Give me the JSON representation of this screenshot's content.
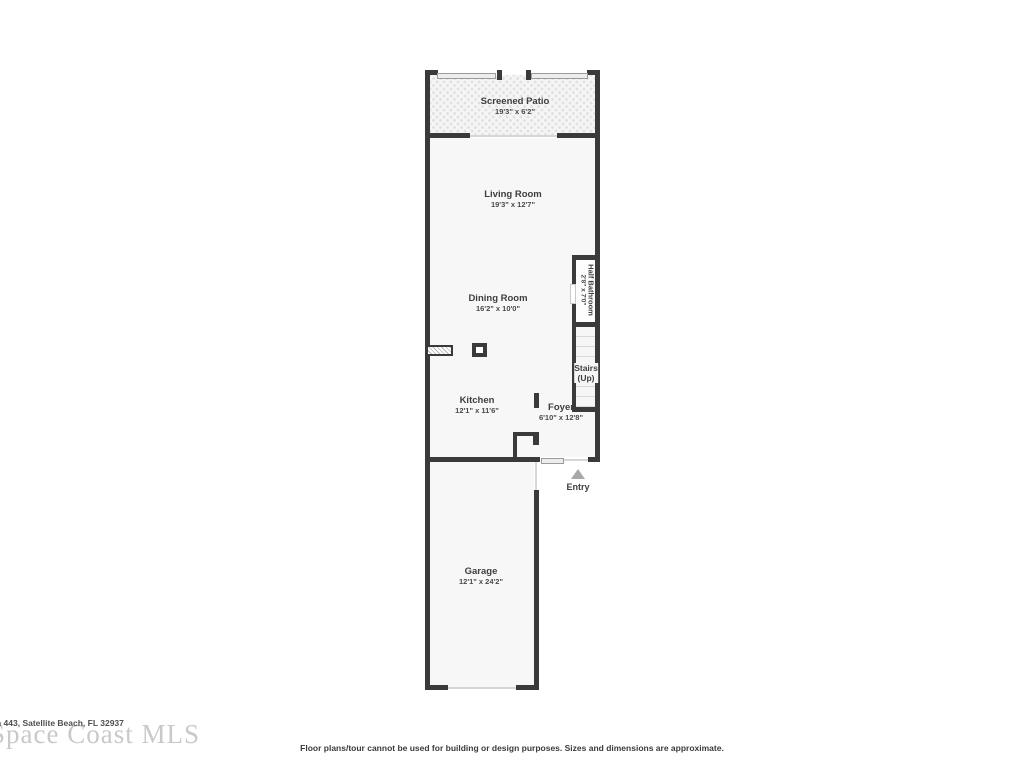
{
  "floor_plan": {
    "rooms": {
      "screened_patio": {
        "name": "Screened Patio",
        "dims": "19'3\" x 6'2\""
      },
      "living_room": {
        "name": "Living Room",
        "dims": "19'3\" x 12'7\""
      },
      "dining_room": {
        "name": "Dining Room",
        "dims": "16'2\" x 10'0\""
      },
      "half_bathroom": {
        "name": "Half Bathroom",
        "dims": "2'8\" x 7'0\""
      },
      "stairs": {
        "name": "Stairs",
        "direction": "(Up)"
      },
      "kitchen": {
        "name": "Kitchen",
        "dims": "12'1\" x 11'6\""
      },
      "foyer": {
        "name": "Foyer",
        "dims": "6'10\" x 12'8\""
      },
      "garage": {
        "name": "Garage",
        "dims": "12'1\" x 24'2\""
      },
      "entry": {
        "label": "Entry"
      }
    },
    "colors": {
      "wall": "#3a3a3c",
      "room_fill": "#f7f7f8",
      "entry_arrow": "#a8a8a8",
      "watermark": "#c9c9c9"
    }
  },
  "watermark": {
    "mls_name": "Space Coast MLS",
    "address": "n 443, Satellite Beach, FL 32937"
  },
  "disclaimer": "Floor plans/tour cannot be used for building or design purposes. Sizes and dimensions are approximate."
}
